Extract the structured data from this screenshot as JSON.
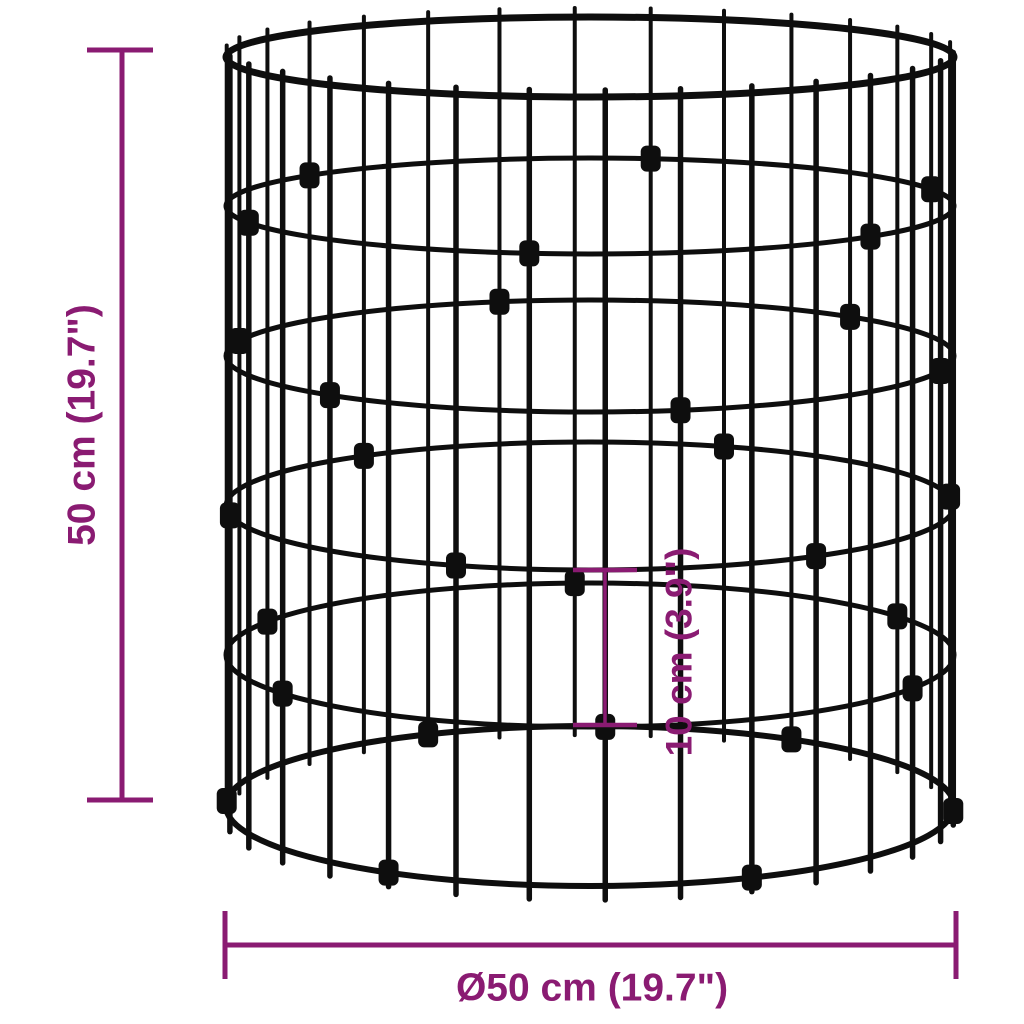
{
  "diagram": {
    "title": "wire gabion cylinder dimension diagram",
    "height_label": "50 cm (19.7\")",
    "diameter_label": "Ø50 cm (19.7\")",
    "spacing_label": "10 cm (3.9\")",
    "accent_color": "#8a1b72",
    "wire_color": "#0e0e0e",
    "background_color": "#ffffff",
    "structure": {
      "type": "wire-gabion-cylinder",
      "rings": 6,
      "vertical_wires": 30,
      "clamp_stagger": 5
    }
  }
}
